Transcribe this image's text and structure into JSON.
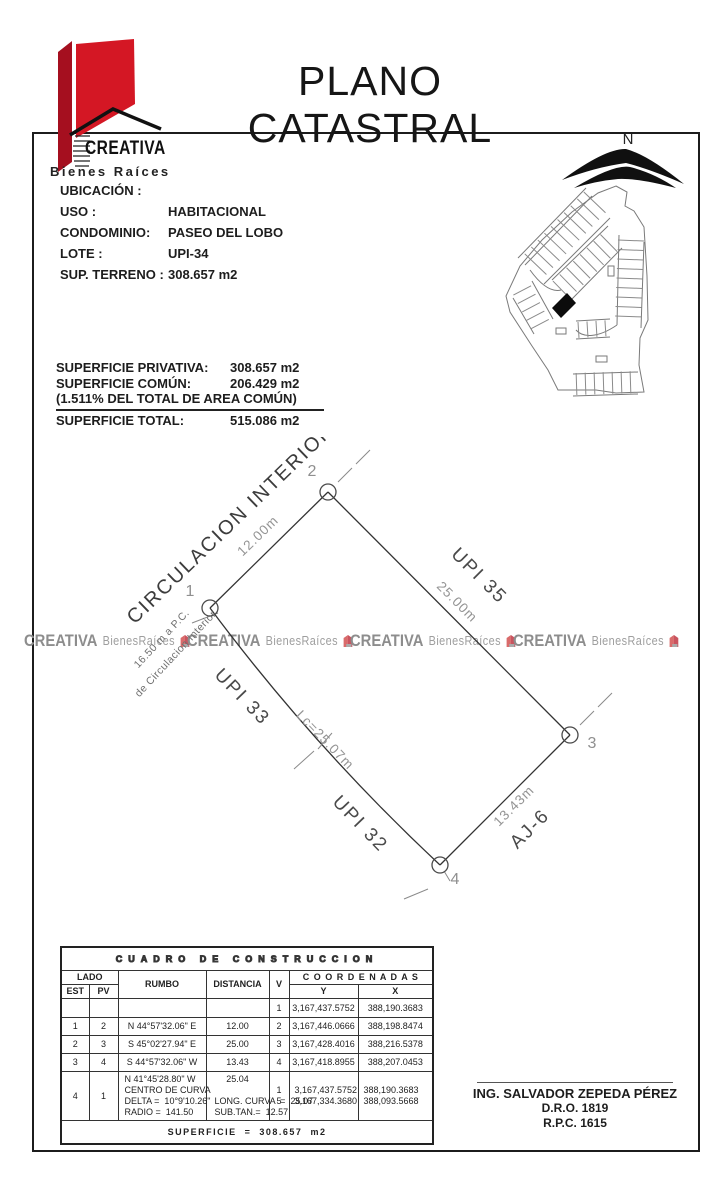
{
  "title": "PLANO CATASTRAL",
  "brand": {
    "name": "CREATIVA",
    "tagline": "Bienes Raíces"
  },
  "north_label": "N",
  "colors": {
    "logo_red_dark": "#a50f1f",
    "logo_red": "#d41724",
    "watermark_gray": "#8d8d8d",
    "watermark_icon_red": "#d96b6b"
  },
  "property": {
    "rows": [
      {
        "label": "UBICACIÓN :",
        "value": ""
      },
      {
        "label": "USO :",
        "value": "HABITACIONAL"
      },
      {
        "label": "CONDOMINIO:",
        "value": "PASEO DEL LOBO"
      },
      {
        "label": "LOTE :",
        "value": "UPI-34"
      },
      {
        "label": "SUP. TERRENO :",
        "value": "308.657 m2"
      }
    ]
  },
  "surfaces": {
    "priv_label": "SUPERFICIE PRIVATIVA:",
    "priv": "308.657 m2",
    "comun_label": "SUPERFICIE COMÚN:",
    "comun": "206.429 m2",
    "note": "(1.511% DEL TOTAL DE AREA COMÚN)",
    "total_label": "SUPERFICIE TOTAL:",
    "total": "515.086 m2"
  },
  "watermark": {
    "brand": "CREATIVA",
    "suffix": "BienesRaíces"
  },
  "plot": {
    "street": "CIRCULACION INTERIOR",
    "dim_12": "12.00m",
    "upi35": "UPI 35",
    "dim_25": "25.00m",
    "upi33": "UPI 33",
    "upi32": "UPI 32",
    "dim_lc": "Lc=25.07m",
    "aj6": "AJ-6",
    "dim_13": "13.43m",
    "v1": "1",
    "v2": "2",
    "v3": "3",
    "v4": "4",
    "note_line1": "16.50 m a P.C.",
    "note_line2": "de Circulacion Interior"
  },
  "table": {
    "title": "CUADRO DE CONSTRUCCION",
    "h_lado": "LADO",
    "h_est": "EST",
    "h_pv": "PV",
    "h_rumbo": "RUMBO",
    "h_dist": "DISTANCIA",
    "h_v": "V",
    "h_coord": "C O O R D E N A D A S",
    "h_y": "Y",
    "h_x": "X",
    "rows": [
      {
        "est": "",
        "pv": "",
        "rumbo": "",
        "dist": "",
        "v": "1",
        "y": "3,167,437.5752",
        "x": "388,190.3683"
      },
      {
        "est": "1",
        "pv": "2",
        "rumbo": "N 44°57'32.06\" E",
        "dist": "12.00",
        "v": "2",
        "y": "3,167,446.0666",
        "x": "388,198.8474"
      },
      {
        "est": "2",
        "pv": "3",
        "rumbo": "S 45°02'27.94\" E",
        "dist": "25.00",
        "v": "3",
        "y": "3,167,428.4016",
        "x": "388,216.5378"
      },
      {
        "est": "3",
        "pv": "4",
        "rumbo": "S 44°57'32.06\" W",
        "dist": "13.43",
        "v": "4",
        "y": "3,167,418.8955",
        "x": "388,207.0453"
      }
    ],
    "curve_row": {
      "est": "4",
      "pv": "1",
      "rumbo1": "N 41°45'28.80\" W",
      "rumbo2": "CENTRO DE CURVA",
      "rumbo3": "DELTA =  10°9'10.26\"",
      "rumbo4": "RADIO =  141.50",
      "dist1": "25.04",
      "dist2": "LONG. CURVA  =  25.07",
      "dist3": "SUB.TAN.=  12.57",
      "v_a": "1",
      "v_b": "5",
      "y_a": "3,167,437.5752",
      "y_b": "3,167,334.3680",
      "x_a": "388,190.3683",
      "x_b": "388,093.5668"
    },
    "footer": "SUPERFICIE  =  308.657  m2"
  },
  "signature": {
    "name": "ING. SALVADOR ZEPEDA PÉREZ",
    "dro": "D.R.O. 1819",
    "rpc": "R.P.C. 1615"
  }
}
